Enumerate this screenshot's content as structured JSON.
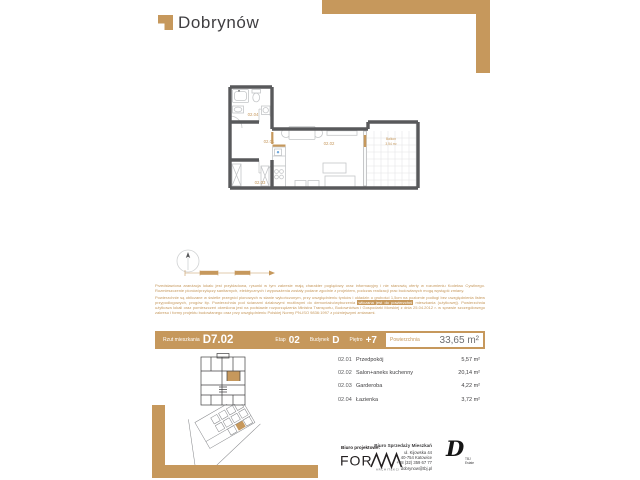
{
  "brand": {
    "name": "Dobrynów"
  },
  "plan": {
    "labels": {
      "hall": "02.01",
      "living": "02.02",
      "wardrobe": "02.03",
      "bath": "02.04"
    },
    "balcony": {
      "name": "Balkon",
      "area": "3,54 m²"
    }
  },
  "disclaimer": {
    "p1": "Przedstawiona aranżacja lokalu jest przykładowa, rysunki w tym zakresie mają charakter poglądowy oraz informacyjny i nie stanowią oferty w rozumieniu Kodeksu Cywilnego. Rozmieszczenie pionów/przyłączy sanitarnych, elektrycznych i wyposażenia zostały podane zgodnie z projektem, podczas realizacji prac budowlanych mogą wystąpić zmiany.",
    "p2_pre": "Powierzchnie są obliczane w świetle przegród pionowych w stanie wykończonym, przy uwzględnieniu tynków i okładzin o grubości 1,5cm na poziomie podłogi bez uwzględnienia listew przypodłogowych, progów itp. Powierzchnia pod ścianami działowymi możliwymi do demontażu/wyburzenia ",
    "p2_highlight": "wliczana jest do powierzchni",
    "p2_post": " mieszkania (użytkowej). Powierzchnia użytkowa lokali oraz pomieszczeń określona jest na podstawie rozporządzenia Ministra Transportu, Budownictwa i Gospodarki Morskiej z dnia 25.04.2012 r. w sprawie szczegółowego zakresu i formy projektu budowlanego oraz przy uwzględnieniu Polskiej Normy PN-ISO 9836:1997 z późniejszymi zmianami."
  },
  "infobar": {
    "plan_label": "Rzut mieszkania",
    "plan_value": "D7.02",
    "stage_label": "Etap",
    "stage_value": "02",
    "building_label": "Budynek",
    "building_value": "D",
    "floor_label": "Piętro",
    "floor_value": "+7",
    "area_label": "Powierzchnia",
    "area_value": "33,65 m²"
  },
  "room_table": {
    "rows": [
      {
        "code": "02.01",
        "name": "Przedpokój",
        "area": "5,57 m²"
      },
      {
        "code": "02.02",
        "name": "Salon+aneks kuchenny",
        "area": "20,14 m²"
      },
      {
        "code": "02.03",
        "name": "Garderoba",
        "area": "4,22 m²"
      },
      {
        "code": "02.04",
        "name": "Łazienka",
        "area": "3,72 m²"
      }
    ]
  },
  "footer": {
    "design_office_label": "Biuro projektowe:",
    "forma_text": "FOR",
    "forma_sub": "ARCHITEKCI",
    "sales_title": "Biuro Sprzedaży Mieszkań",
    "address_line1": "ul. Kijowska 44",
    "address_line2": "40-754 Katowice",
    "phone": "+48 (32) 359 67 77",
    "email": "dobrynow@tbj.pl",
    "tbj_letter": "D",
    "tbj_line1": "TBJ",
    "tbj_line2": "Estate"
  },
  "colors": {
    "accent": "#C6985C",
    "wall": "#58595B",
    "text": "#414042"
  }
}
